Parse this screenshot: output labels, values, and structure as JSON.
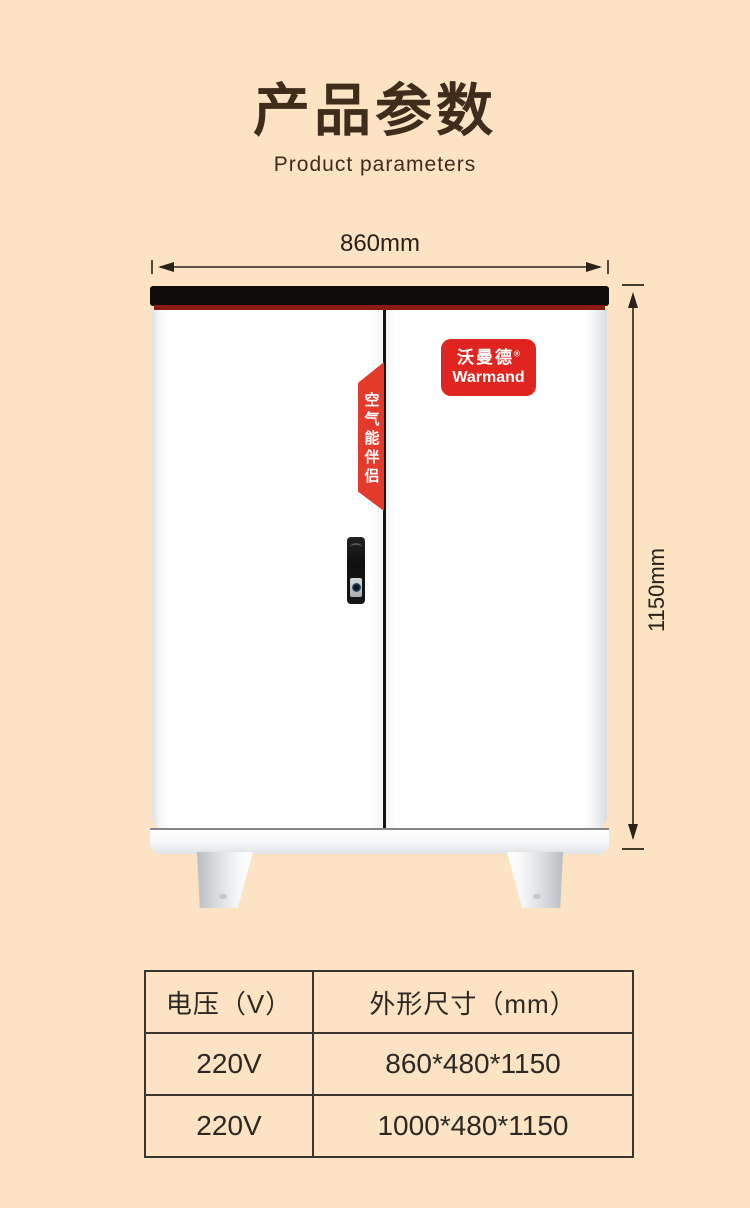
{
  "page": {
    "background": "#fbe3c3"
  },
  "header": {
    "title": "产品参数",
    "subtitle": "Product parameters"
  },
  "diagram": {
    "width_label": "860mm",
    "height_label": "1150mm",
    "ribbon_text": "空气能伴侣",
    "badge": {
      "brand_cn": "沃曼德",
      "reg_mark": "®",
      "brand_en": "Warmand"
    }
  },
  "spec_table": {
    "headers": [
      "电压（V）",
      "外形尺寸（mm）"
    ],
    "rows": [
      [
        "220V",
        "860*480*1150"
      ],
      [
        "220V",
        "1000*480*1150"
      ]
    ]
  },
  "colors": {
    "accent_red": "#e0241f",
    "ribbon_red": "#e43a2c",
    "title_brown": "#3f2c1b",
    "dimension_line": "#2a2118",
    "table_border": "#3a362e"
  }
}
